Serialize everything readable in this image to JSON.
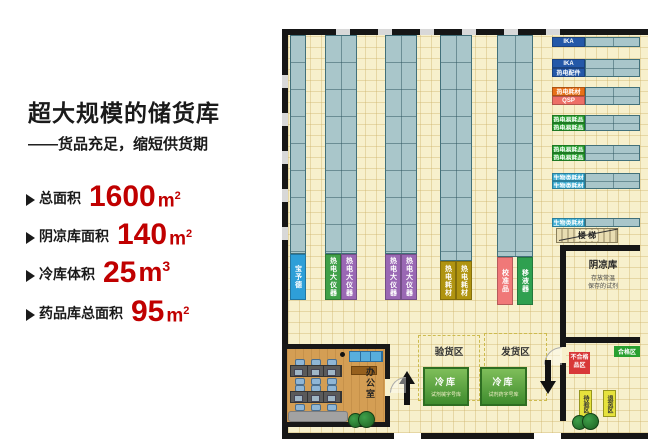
{
  "panel": {
    "title": "超大规模的储货库",
    "subtitle": "——货品充足，缩短供货期",
    "accent_color": "#c00000",
    "specs": [
      {
        "label": "总面积",
        "value": "1600",
        "unit": "m",
        "sup": "2"
      },
      {
        "label": "阴凉库面积",
        "value": "140",
        "unit": "m",
        "sup": "2"
      },
      {
        "label": "冷库体积",
        "value": "25",
        "unit": "m",
        "sup": "3"
      },
      {
        "label": "药品库总面积",
        "value": "95",
        "unit": "m",
        "sup": "2"
      }
    ]
  },
  "plan": {
    "vertical_rack_labels": [
      {
        "text": "宝予德",
        "color": "#2e9fd8"
      },
      {
        "text": "热电大仪器",
        "color": "#3fa048"
      },
      {
        "text": "热电大仪器",
        "color": "#9a68b4"
      },
      {
        "text": "热电大仪器",
        "color": "#9a68b4"
      },
      {
        "text": "热电大仪器",
        "color": "#9a68b4"
      },
      {
        "text": "热电耗材",
        "color": "#b09410"
      },
      {
        "text": "热电耗材",
        "color": "#b09410"
      },
      {
        "text": "校准品",
        "color": "#f07878"
      },
      {
        "text": "移液器",
        "color": "#2fa050"
      }
    ],
    "right_rack_labels": [
      {
        "text": "IKA",
        "color": "#2458a8"
      },
      {
        "text": "IKA",
        "color": "#2458a8"
      },
      {
        "text": "热电配件",
        "color": "#2458a8"
      },
      {
        "text": "热电耗材",
        "color": "#e87018"
      },
      {
        "text": "QSP",
        "color": "#ed6e66"
      },
      {
        "text": "热电易耗品",
        "color": "#28a030"
      },
      {
        "text": "热电易耗品",
        "color": "#28a030"
      },
      {
        "text": "热电易耗品",
        "color": "#28a030"
      },
      {
        "text": "热电易耗品",
        "color": "#28a030"
      },
      {
        "text": "生物类耗材",
        "color": "#38aad0"
      },
      {
        "text": "生物类耗材",
        "color": "#38aad0"
      },
      {
        "text": "生物类耗材",
        "color": "#38aad0"
      }
    ],
    "stairs_label": "楼 梯",
    "cool_room": {
      "name": "阴凉库",
      "desc_line1": "存放常温",
      "desc_line2": "保存的试剂"
    },
    "zones": {
      "inspection": "验货区",
      "shipping": "发货区"
    },
    "cold_rooms": [
      {
        "name": "冷库",
        "sub": "试剂械字号库"
      },
      {
        "name": "冷库",
        "sub": "试剂药字号库"
      }
    ],
    "right_room": {
      "qualified": "合格区",
      "unqualified_line1": "不合格",
      "unqualified_line2": "品区",
      "pending": "待验区",
      "returns": "退货区"
    },
    "office": {
      "name": "办公室"
    }
  }
}
